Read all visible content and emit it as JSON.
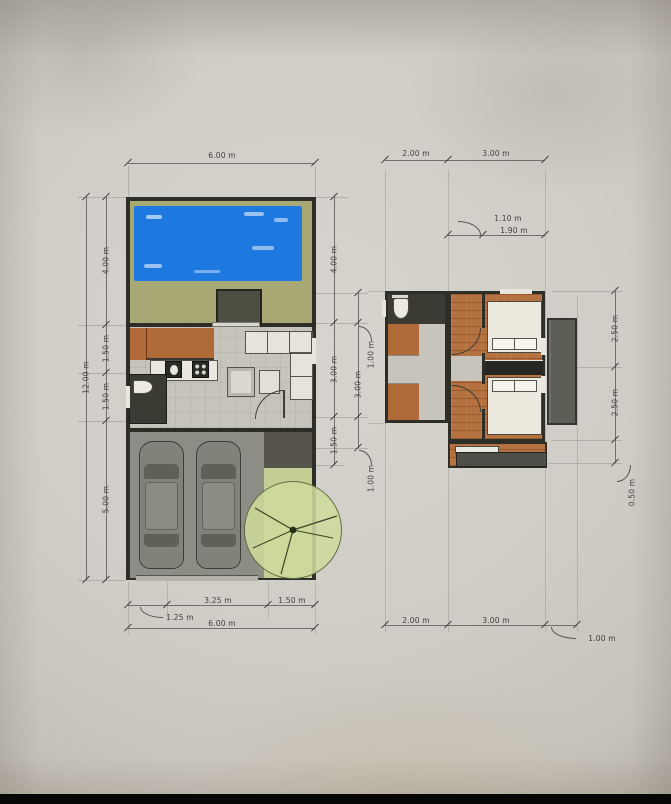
{
  "document": {
    "kind": "architectural floor plan photo",
    "plans": [
      "ground-floor-site-plan",
      "upper-floor-plan"
    ]
  },
  "ground_floor": {
    "top_total": "6.00 m",
    "left_total": "12.00 m",
    "left_segments": [
      "4.00 m",
      "1.50 m",
      "1.50 m",
      "5.00 m"
    ],
    "right_segments": [
      "4.00 m",
      "3.00 m",
      "1.50 m"
    ],
    "right_outer_segments": [
      "1.00 m",
      "3.00 m",
      "1.00 m"
    ],
    "bottom_segments": [
      "1.25 m",
      "3.25 m",
      "1.50 m"
    ],
    "bottom_total": "6.00 m"
  },
  "upper_floor": {
    "top_segments": [
      "2.00 m",
      "3.00 m"
    ],
    "window_segments": [
      "1.10 m",
      "1.90 m"
    ],
    "right_segments": [
      "2.50 m",
      "2.50 m",
      "0.50 m"
    ],
    "bottom_segments": [
      "2.00 m",
      "3.00 m",
      "1.00 m"
    ]
  },
  "colors": {
    "pool": "#1d79e0",
    "grass": "#a7a873",
    "tree": "#ccd79f",
    "wood": "#b5713f",
    "stair": "#b06a38",
    "wall": "#2e2e29",
    "floor": "#c7c4bb",
    "garage": "#8d8d85",
    "balcony": "#5c5d55",
    "paper": "#d0cdc6",
    "ink": "#3f3f3b",
    "line": "#70706a"
  }
}
